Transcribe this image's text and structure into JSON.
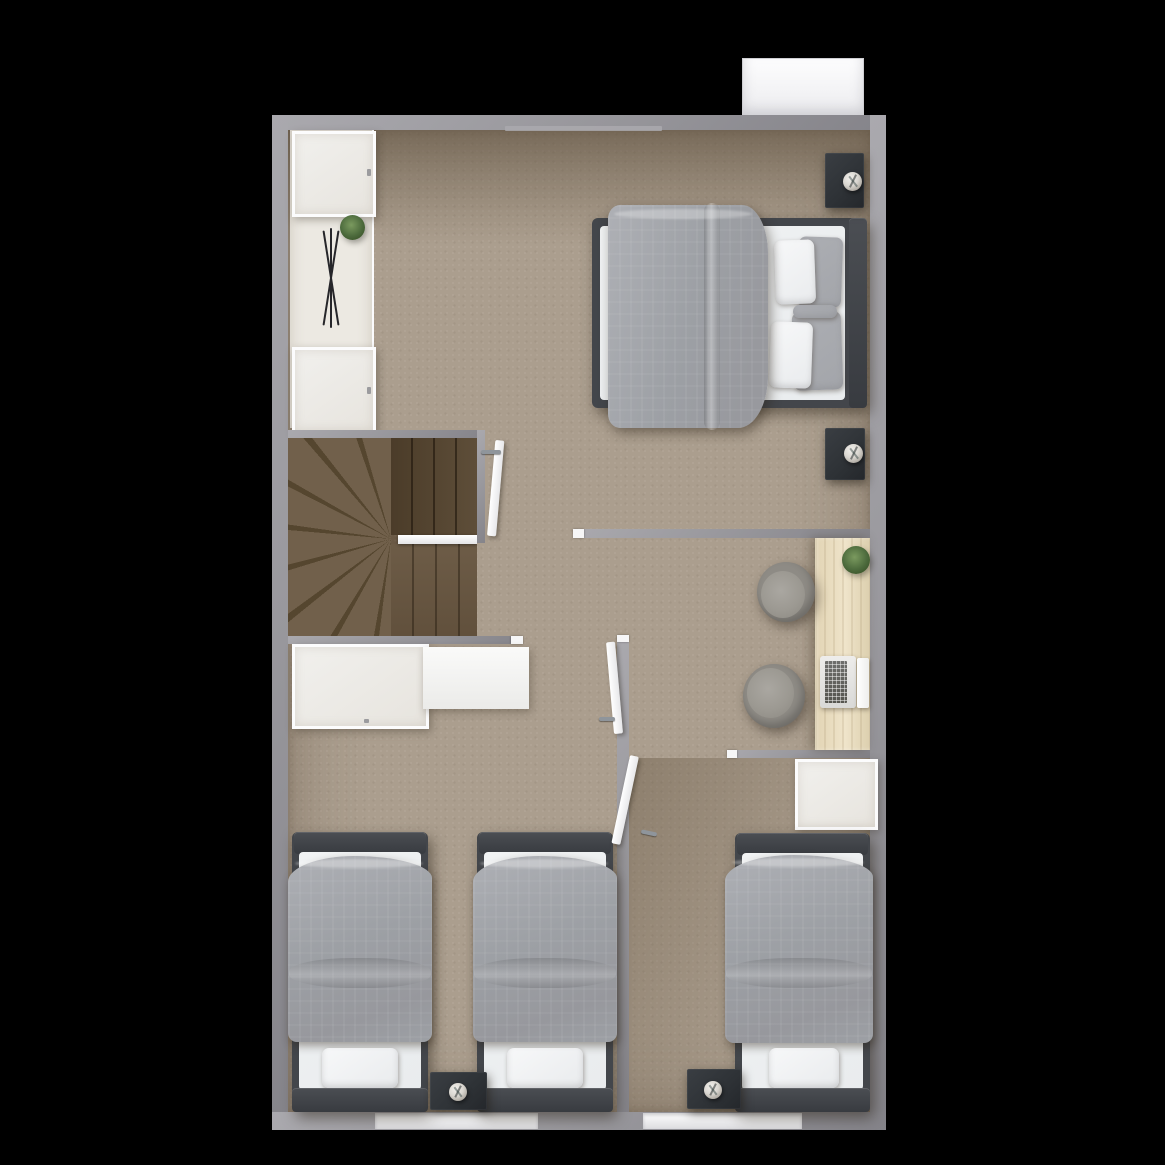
{
  "palette": {
    "background": "#000000",
    "wallOuter": "#97969b",
    "wallInner": "#85848a",
    "wallHighlight": "#aaa9ae",
    "floorBase": "#ab9e8e",
    "floorCream": "#ece9e2",
    "stairBase": "#6a5945",
    "white": "#f6f6f7",
    "bedFrame": "#43464b",
    "bedHeadboard": "#383b40",
    "mattress": "#e9ecee",
    "duvet": "#9da0a5",
    "duvetLight": "#aeb0b5",
    "pillowGray": "#a3a5aa",
    "nightstand": "#2e3236",
    "lampShade": "#d9d6d0",
    "deskWood": "#e2d4b4",
    "deskWoodLight": "#efe4ca",
    "chairBody": "#8e8b85",
    "chairSeat": "#9c9992",
    "plantGreen": "#4c6a3c",
    "plantDark": "#31471f",
    "laptopBody": "#d9d9d7",
    "laptopKeys": "#6e6e6c",
    "windowWhite": "#fafafb"
  },
  "scene": {
    "type": "3d_rendered_floor_plan",
    "view": "top_down",
    "background": "black",
    "rooms": [
      {
        "name": "master-bedroom",
        "position": "top",
        "furniture": [
          "double-bed",
          "gray duvet",
          "2 white pillows",
          "2 gray pillows",
          "bolster pillow",
          "dark nightstand with lamp (upper)",
          "dark nightstand with lamp (lower)",
          "wardrobe shelf (upper)",
          "wardrobe shelf (lower)",
          "potted plant",
          "clothes airer",
          "white door"
        ]
      },
      {
        "name": "staircase",
        "position": "middle-left",
        "furniture": [
          "winder stairs",
          "white handrail"
        ]
      },
      {
        "name": "hallway",
        "position": "middle",
        "furniture": [
          "white counter",
          "white cabinet"
        ]
      },
      {
        "name": "study-nook",
        "position": "middle-right",
        "furniture": [
          "wooden desk",
          "tub chair (upper)",
          "tub chair (lower)",
          "laptop",
          "tablet stand",
          "potted plant"
        ]
      },
      {
        "name": "twin-bedroom",
        "position": "bottom-left",
        "furniture": [
          "single bed (left)",
          "single bed (right)",
          "shared nightstand with lamp",
          "white door",
          "window"
        ]
      },
      {
        "name": "single-bedroom",
        "position": "bottom-right",
        "furniture": [
          "single bed",
          "white nightstand",
          "dark nightstand with lamp",
          "white door",
          "window"
        ]
      }
    ],
    "exterior_features": [
      "white balcony ledge at top-right",
      "two white windows in bottom wall"
    ],
    "counts": {
      "beds": 4,
      "doors": 3,
      "nightstands": 5,
      "lamps": 4,
      "chairs": 2,
      "plants": 3,
      "windows": 2
    }
  }
}
